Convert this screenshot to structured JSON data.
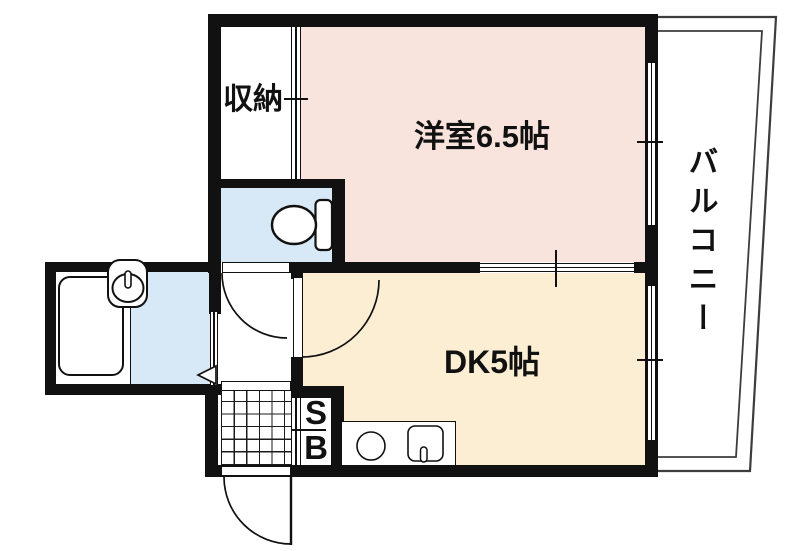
{
  "floor_plan": {
    "labels": {
      "closet": "収納",
      "western_room": "洋室6.5帖",
      "balcony": "バルコニー",
      "dining_kitchen": "DK5帖",
      "shoe_box_top": "S",
      "shoe_box_bottom": "B"
    },
    "colors": {
      "western_room_fill": "#f9e4dd",
      "dining_kitchen_fill": "#fbeed3",
      "sanitary_fill": "#d7e8f6",
      "wall": "#111111",
      "balcony_line": "#3d3d3d"
    }
  }
}
